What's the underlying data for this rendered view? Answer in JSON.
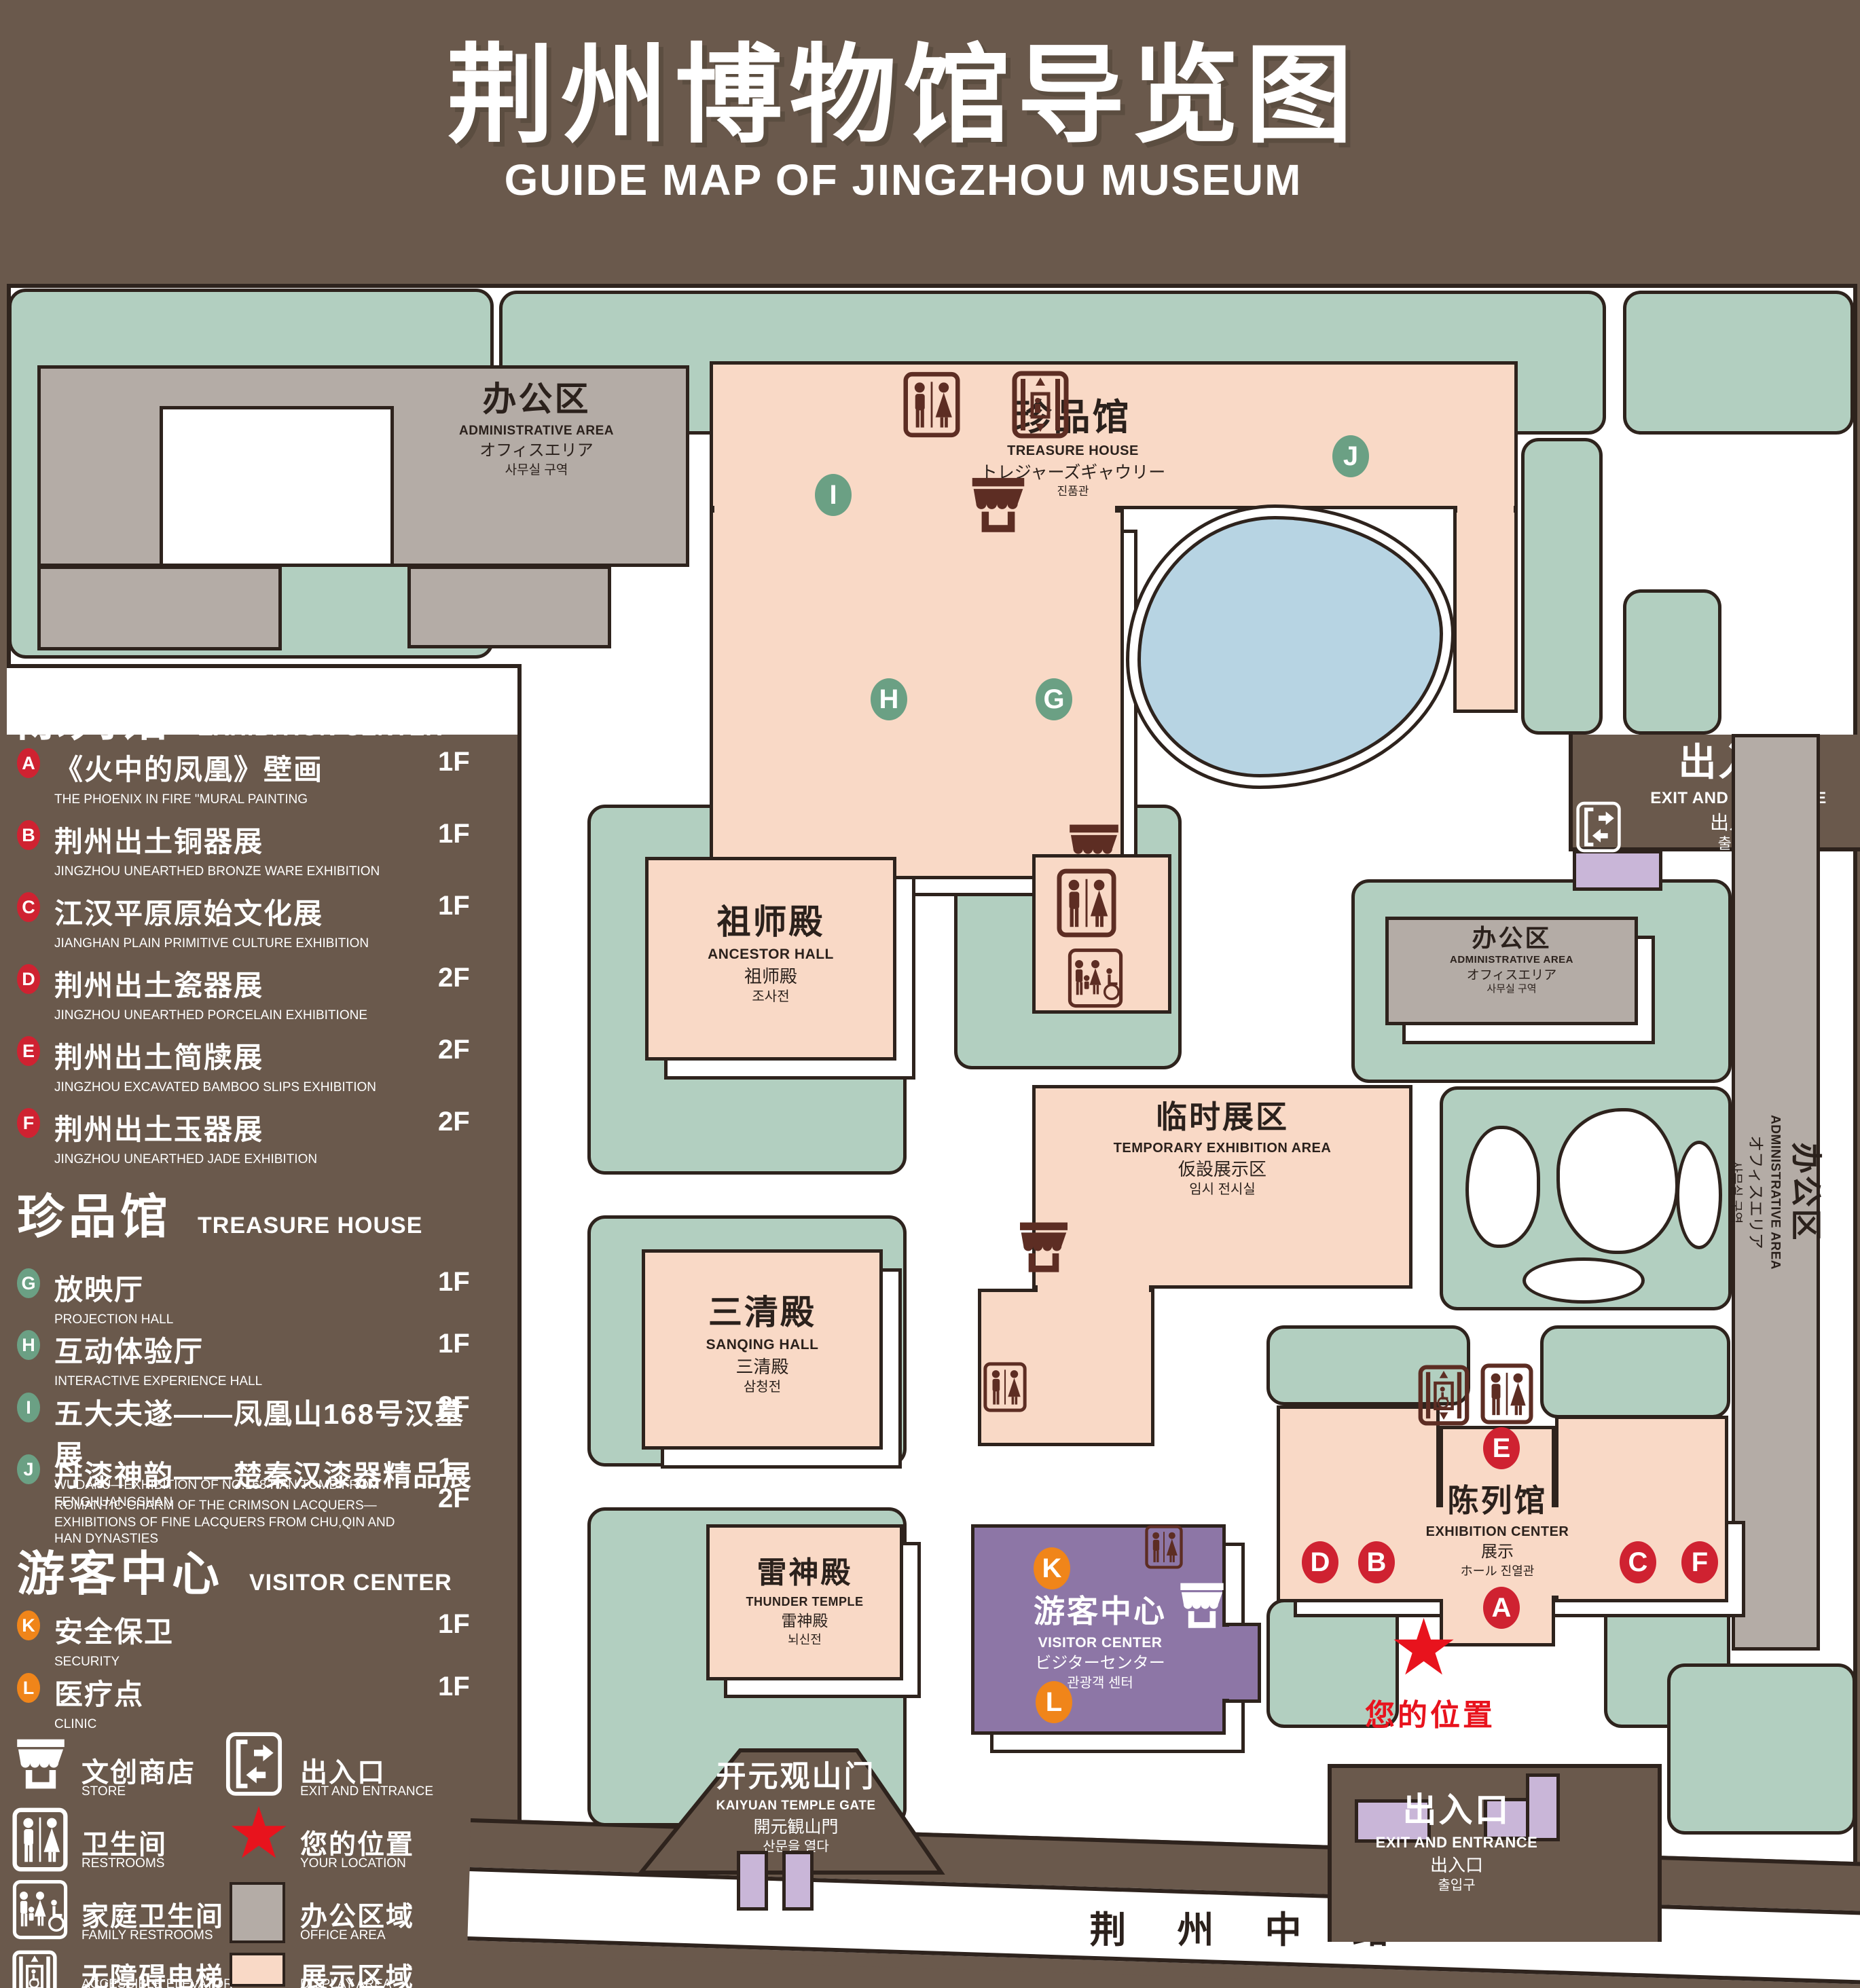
{
  "title": {
    "zh": "荆州博物馆导览图",
    "en": "GUIDE MAP OF JINGZHOU MUSEUM"
  },
  "colors": {
    "background": "#6a594c",
    "display_area": "#f9d9c6",
    "office_area": "#b4aca6",
    "lawn": "#b2cfc0",
    "pond": "#b7d4e3",
    "visitor_center": "#8d76a6",
    "marker_red": "#cf2231",
    "marker_green": "#6ba084",
    "marker_orange": "#f0851a",
    "location_red": "#e8131d",
    "icon_dark": "#5d2d23"
  },
  "legend": {
    "sections": [
      {
        "zh": "陈列馆",
        "en": "EXHIBITION CENTER",
        "items": [
          {
            "letter": "A",
            "zh": "《火中的凤凰》壁画",
            "en": "THE PHOENIX IN FIRE \"MURAL PAINTING",
            "floor": "1F"
          },
          {
            "letter": "B",
            "zh": "荆州出土铜器展",
            "en": "JINGZHOU UNEARTHED BRONZE WARE EXHIBITION",
            "floor": "1F"
          },
          {
            "letter": "C",
            "zh": "江汉平原原始文化展",
            "en": "JIANGHAN PLAIN PRIMITIVE CULTURE EXHIBITION",
            "floor": "1F"
          },
          {
            "letter": "D",
            "zh": "荆州出土瓷器展",
            "en": "JINGZHOU UNEARTHED PORCELAIN EXHIBITIONE",
            "floor": "2F"
          },
          {
            "letter": "E",
            "zh": "荆州出土简牍展",
            "en": "JINGZHOU EXCAVATED BAMBOO SLIPS EXHIBITION",
            "floor": "2F"
          },
          {
            "letter": "F",
            "zh": "荆州出土玉器展",
            "en": "JINGZHOU UNEARTHED JADE EXHIBITION",
            "floor": "2F"
          }
        ]
      },
      {
        "zh": "珍品馆",
        "en": "TREASURE HOUSE",
        "items": [
          {
            "letter": "G",
            "zh": "放映厅",
            "en": "PROJECTION HALL",
            "floor": "1F"
          },
          {
            "letter": "H",
            "zh": "互动体验厅",
            "en": "INTERACTIVE EXPERIENCE HALL",
            "floor": "1F"
          },
          {
            "letter": "I",
            "zh": "五大夫遂——凤凰山168号汉墓展",
            "en": "WUDAFU—EXHIBITION OF NO.168 HAN TOMB FROM FENGHUANGSHAN",
            "floor": "2F"
          },
          {
            "letter": "J",
            "zh": "丹漆神韵——楚秦汉漆器精品展",
            "en": "ROMANTIC CHARM OF THE CRIMSON LACQUERS—EXHIBITIONS OF FINE LACQUERS FROM CHU,QIN AND HAN DYNASTIES",
            "floor": "1-2F"
          }
        ]
      },
      {
        "zh": "游客中心",
        "en": "VISITOR CENTER",
        "items": [
          {
            "letter": "K",
            "zh": "安全保卫",
            "en": "SECURITY",
            "floor": "1F"
          },
          {
            "letter": "L",
            "zh": "医疗点",
            "en": "CLINIC",
            "floor": "1F"
          }
        ]
      }
    ],
    "symbols": [
      {
        "id": "store",
        "zh": "文创商店",
        "en": "STORE"
      },
      {
        "id": "exit",
        "zh": "出入口",
        "en": "EXIT AND ENTRANCE"
      },
      {
        "id": "restrooms",
        "zh": "卫生间",
        "en": "RESTROOMS"
      },
      {
        "id": "your-location",
        "zh": "您的位置",
        "en": "YOUR LOCATION"
      },
      {
        "id": "family-restrooms",
        "zh": "家庭卫生间",
        "en": "FAMILY RESTROOMS"
      },
      {
        "id": "office-area",
        "zh": "办公区域",
        "en": "OFFICE AREA"
      },
      {
        "id": "accessible-elevator",
        "zh": "无障碍电梯",
        "en": "ACCESSIBLE ELEVATOR"
      },
      {
        "id": "display-area",
        "zh": "展示区域",
        "en": "DISPLAY AREA"
      },
      {
        "id": "elevator",
        "zh": "电梯",
        "en": "Elevator"
      }
    ]
  },
  "map": {
    "buildings": {
      "admin": {
        "zh": "办公区",
        "en": "ADMINISTRATIVE AREA",
        "ja": "オフィスエリア",
        "ko": "사무실 구역"
      },
      "treasure": {
        "zh": "珍品馆",
        "en": "TREASURE HOUSE",
        "ja": "トレジャーズギャウリー",
        "ko": "진품관"
      },
      "ancestor": {
        "zh": "祖师殿",
        "en": "ANCESTOR HALL",
        "ja": "祖师殿",
        "ko": "조사전"
      },
      "temporary": {
        "zh": "临时展区",
        "en": "TEMPORARY EXHIBITION AREA",
        "ja": "仮設展示区",
        "ko": "임시 전시실"
      },
      "sanqing": {
        "zh": "三清殿",
        "en": "SANQING HALL",
        "ja": "三清殿",
        "ko": "삼청전"
      },
      "thunder": {
        "zh": "雷神殿",
        "en": "THUNDER TEMPLE",
        "ja": "雷神殿",
        "ko": "뇌신전"
      },
      "visitor": {
        "zh": "游客中心",
        "en": "VISITOR CENTER",
        "ja": "ビジターセンター",
        "ko": "관광객 센터"
      },
      "exhibition": {
        "zh": "陈列馆",
        "en": "EXHIBITION CENTER",
        "ja": "展示",
        "ko": "ホール 진열관"
      },
      "gate": {
        "zh": "开元观山门",
        "en": "KAIYUAN TEMPLE GATE",
        "ja": "開元観山門",
        "ko": "산문을 열다"
      }
    },
    "exit_label": {
      "zh": "出入口",
      "en": "EXIT AND ENTRANCE",
      "ja": "出入口",
      "ko": "출입구"
    },
    "road": "荆 州 中 路",
    "your_location": "您的位置"
  }
}
